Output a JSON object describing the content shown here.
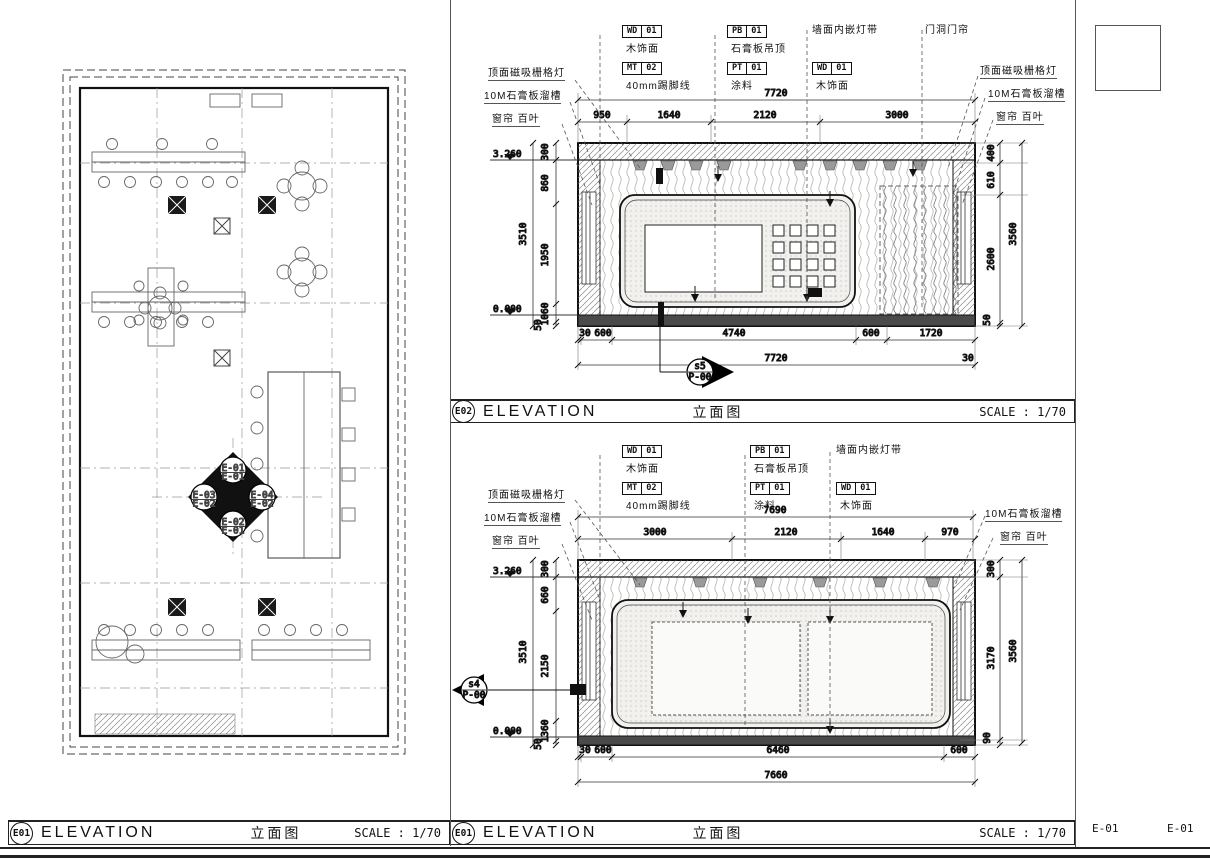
{
  "titlebars": {
    "plan": {
      "tag": "E01",
      "title": "ELEVATION",
      "title_cn": "立面图",
      "scale": "SCALE : 1/70"
    },
    "top": {
      "tag": "E02",
      "title": "ELEVATION",
      "title_cn": "立面图",
      "scale": "SCALE : 1/70"
    },
    "bottom": {
      "tag": "E01",
      "title": "ELEVATION",
      "title_cn": "立面图",
      "scale": "SCALE : 1/70"
    }
  },
  "sheet": {
    "labels": [
      "E-01",
      "E-01"
    ]
  },
  "plan": {
    "diamond": {
      "top": [
        "E-01",
        "E-01"
      ],
      "left": [
        "E-03",
        "E-02"
      ],
      "right": [
        "E-04",
        "E-02"
      ],
      "bottom": [
        "E-02",
        "E-01"
      ]
    }
  },
  "materials": {
    "wd": {
      "code": "WD",
      "num": "01",
      "label": "木饰面"
    },
    "mt": {
      "code": "MT",
      "num": "02",
      "label": "40mm踢脚线"
    },
    "pb": {
      "code": "PB",
      "num": "01",
      "label": "石膏板吊顶"
    },
    "pt": {
      "code": "PT",
      "num": "01",
      "label": "涂料"
    }
  },
  "annotations": {
    "wall_light": "墙面内嵌灯带",
    "door_curtain": "门洞门帘",
    "grid_light": "顶面磁吸栅格灯",
    "gypsum_slot": "10M石膏板溜槽",
    "curtain_blind": "窗帘 百叶"
  },
  "levels": {
    "top": "3.260",
    "floor": "0.000"
  },
  "elev1": {
    "dims_top_total": "7720",
    "dims_top": [
      "950",
      "1640",
      "2120",
      "3000"
    ],
    "dims_left": [
      "300",
      "860",
      "1950",
      "1060",
      "50"
    ],
    "dims_left_total": "3510",
    "dims_right": [
      "400",
      "610",
      "2600",
      "50"
    ],
    "dims_right_total": "3560",
    "dims_bottom": [
      "30",
      "600",
      "4740",
      "600",
      "1720"
    ],
    "dims_bottom_total": "7720",
    "dims_bottom_right": "30",
    "marker": {
      "top": "s5",
      "bottom": "P-00"
    }
  },
  "elev2": {
    "dims_top_total": "7690",
    "dims_top": [
      "3000",
      "2120",
      "1640",
      "970"
    ],
    "dims_left": [
      "300",
      "660",
      "2150",
      "1360",
      "50"
    ],
    "dims_left_total": "3510",
    "dims_right": [
      "300",
      "3170",
      "90"
    ],
    "dims_right_total": "3560",
    "dims_bottom": [
      "30",
      "600",
      "6460",
      "600"
    ],
    "dims_bottom_total": "7660",
    "marker": {
      "top": "s4",
      "bottom": "P-00"
    }
  }
}
